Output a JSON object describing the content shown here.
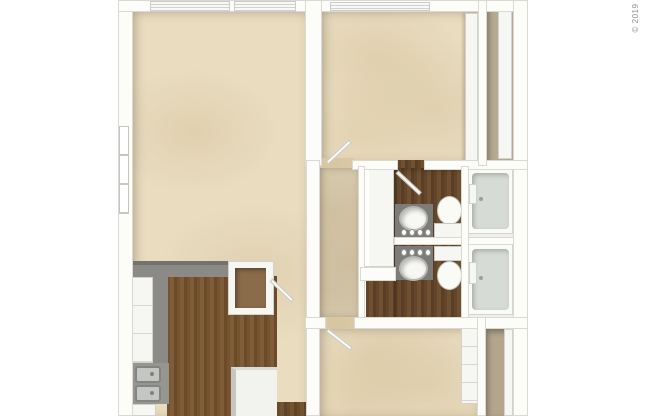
{
  "meta": {
    "type": "3d-floor-plan",
    "description": "Top-down 3D rendered one-bedroom-plus-den apartment floor plan on white background"
  },
  "watermark": {
    "text": "© 2019"
  },
  "colors": {
    "background": "#ffffff",
    "carpet": "#e9dcbf",
    "kitchen_wood": "#75532f",
    "bathroom_wood": "#63452a",
    "wall": "#fcfcf9",
    "wall_edge": "#dadad3",
    "counter_gray": "#8b8a86",
    "tub_interior": "#d7dbd6",
    "closet_interior": "#b6aa92",
    "watermark_text": "#8f8f8f"
  },
  "regions": [
    {
      "name": "living-dining-area",
      "floor": "carpet"
    },
    {
      "name": "kitchen",
      "floor": "wood"
    },
    {
      "name": "bedroom-top",
      "floor": "carpet"
    },
    {
      "name": "bedroom-bottom",
      "floor": "carpet"
    },
    {
      "name": "hallway",
      "floor": "carpet"
    },
    {
      "name": "bathroom-top",
      "floor": "wood"
    },
    {
      "name": "bathroom-bottom",
      "floor": "wood"
    },
    {
      "name": "linen-closet",
      "floor": "none"
    },
    {
      "name": "closet-top-right",
      "floor": "wood"
    },
    {
      "name": "closet-bottom-right",
      "floor": "wood"
    },
    {
      "name": "entry",
      "floor": "wood"
    }
  ],
  "fixtures": [
    "window-blinds-living-1",
    "window-blinds-living-2",
    "window-blinds-bedroom",
    "side-window",
    "kitchen-counter",
    "kitchen-cabinets",
    "kitchen-double-sink",
    "range",
    "upper-cabinet-open",
    "kitchen-island",
    "entry-flooring",
    "vanity-sink-1",
    "toilet-1",
    "bathtub-1",
    "vanity-sink-2",
    "toilet-2",
    "bathtub-2",
    "wardrobe-bedroom-top",
    "sliding-closet-door-top-right",
    "dresser-bedroom-bottom",
    "sliding-closet-door-bottom-right",
    "open-door-bedroom-top",
    "open-door-bathroom-1",
    "open-door-bedroom-bottom"
  ]
}
